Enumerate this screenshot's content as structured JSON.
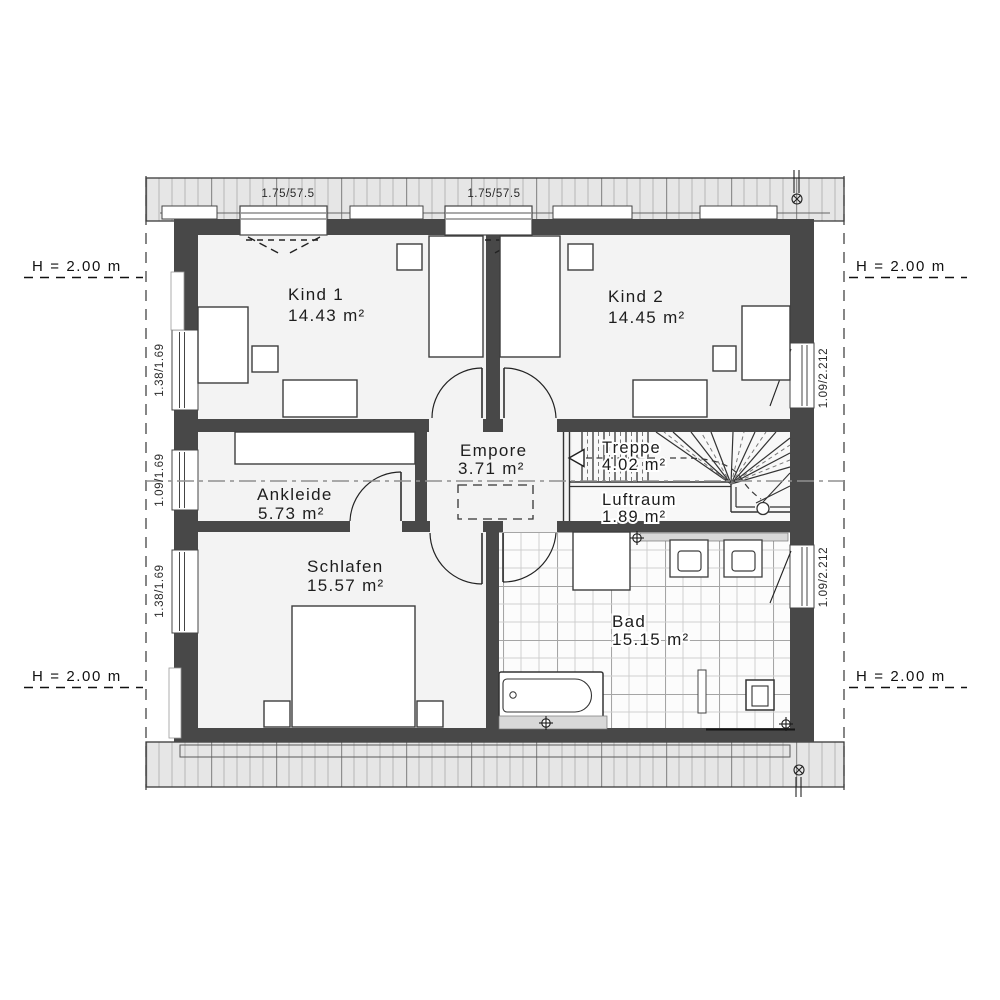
{
  "rooms": {
    "kind1": {
      "name": "Kind 1",
      "area": "14.43 m²"
    },
    "kind2": {
      "name": "Kind 2",
      "area": "14.45 m²"
    },
    "ankleide": {
      "name": "Ankleide",
      "area": "5.73 m²"
    },
    "empore": {
      "name": "Empore",
      "area": "3.71 m²"
    },
    "treppe": {
      "name": "Treppe",
      "area": "4.02 m²"
    },
    "luftraum": {
      "name": "Luftraum",
      "area": "1.89 m²"
    },
    "schlafen": {
      "name": "Schlafen",
      "area": "15.57 m²"
    },
    "bad": {
      "name": "Bad",
      "area": "15.15 m²"
    }
  },
  "annotations": {
    "height_mark": "H = 2.00 m",
    "roof_windows": {
      "left": "1.75/57.5",
      "right": "1.75/57.5"
    },
    "windows_left": [
      "1.38/1.69",
      "1.09/1.69",
      "1.38/1.69"
    ],
    "windows_right": [
      "1.09/2.212",
      "1.09/2.212"
    ]
  },
  "colors": {
    "wall": "#484848",
    "room_fill": "#f3f3f3",
    "roof_overhang": "#e6e6e6",
    "tile_line": "#cfcfcf",
    "section_line": "#909090",
    "text": "#1d1d1d"
  }
}
